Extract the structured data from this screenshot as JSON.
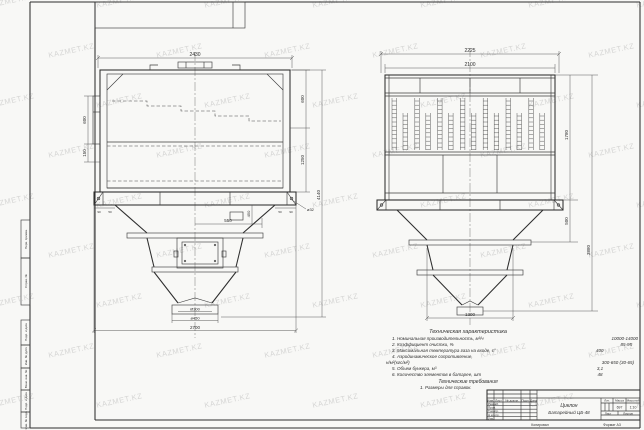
{
  "colors": {
    "line": "#3d3d3d",
    "paper": "#f8f8f6",
    "watermark": "#a5a5a5"
  },
  "sheet": {
    "watermark": "KAZMET.KZ",
    "copied_note": "Копировал",
    "format_note": "Формат А3",
    "margin_labels": {
      "top": [
        "Перв. примен.",
        "Справ. №"
      ],
      "bottom": [
        "Подп. и дата",
        "Инв. № дубл.",
        "Взам. инв. №",
        "Подп. и дата",
        "Инв. № подл."
      ]
    }
  },
  "front_view": {
    "dims": {
      "top_width": "2430",
      "left_upper": "600",
      "left_lower": "150",
      "right_upper": "600",
      "right_lower": "1250",
      "overall_height": "4140",
      "flange_left_a": "90",
      "flange_left_b": "50",
      "flange_right_a": "50",
      "flange_right_b": "90",
      "bolt_hole": "ø32",
      "door_offset": "550",
      "fitting_drop": "450",
      "outlet_inner": "Ø300",
      "outlet_flange": "ø450",
      "bottom_width": "2700"
    }
  },
  "side_view": {
    "dims": {
      "top_width": "2225",
      "inner_width": "2100",
      "body_height": "1780",
      "skirt_height": "500",
      "overall_height": "3880",
      "hopper_width": "1300"
    }
  },
  "tech_specs": {
    "title": "Техническая характеристика",
    "items": [
      {
        "label": "1. Номинальная производительность, м³/ч",
        "value": "10000-14000"
      },
      {
        "label": "2. Коэффициент очистки, %",
        "value": "85-95"
      },
      {
        "label": "3. Максимальная температура газа на входе, с°",
        "value": "400"
      },
      {
        "label": "4. Аэродинамическое сопротивление,",
        "value": ""
      },
      {
        "label": "н/м²(кгс/м²)",
        "value": "300-650 (30-65)"
      },
      {
        "label": "5. Объем бункера, м³",
        "value": "3,1"
      },
      {
        "label": "6. Количество элементов в батарее, шт",
        "value": "48"
      }
    ],
    "requirements_title": "Технические требования",
    "requirements": [
      "1. Размеры для справок."
    ]
  },
  "title_block": {
    "doc_title_line1": "Циклон",
    "doc_title_line2": "Батарейный ЦБ-48",
    "header_cells": [
      "Изм.",
      "Лист",
      "№ докум.",
      "Подп.",
      "Дата"
    ],
    "rows": [
      "Разраб.",
      "Пров.",
      "Т.контр.",
      "Н.контр.",
      "Утв."
    ],
    "lit_label": "Лит.",
    "mass_label": "Масса",
    "mass_value": "697",
    "scale_label": "Масштаб",
    "scale_value": "1:10",
    "sheet_label": "Лист",
    "sheets_label": "Листов"
  }
}
